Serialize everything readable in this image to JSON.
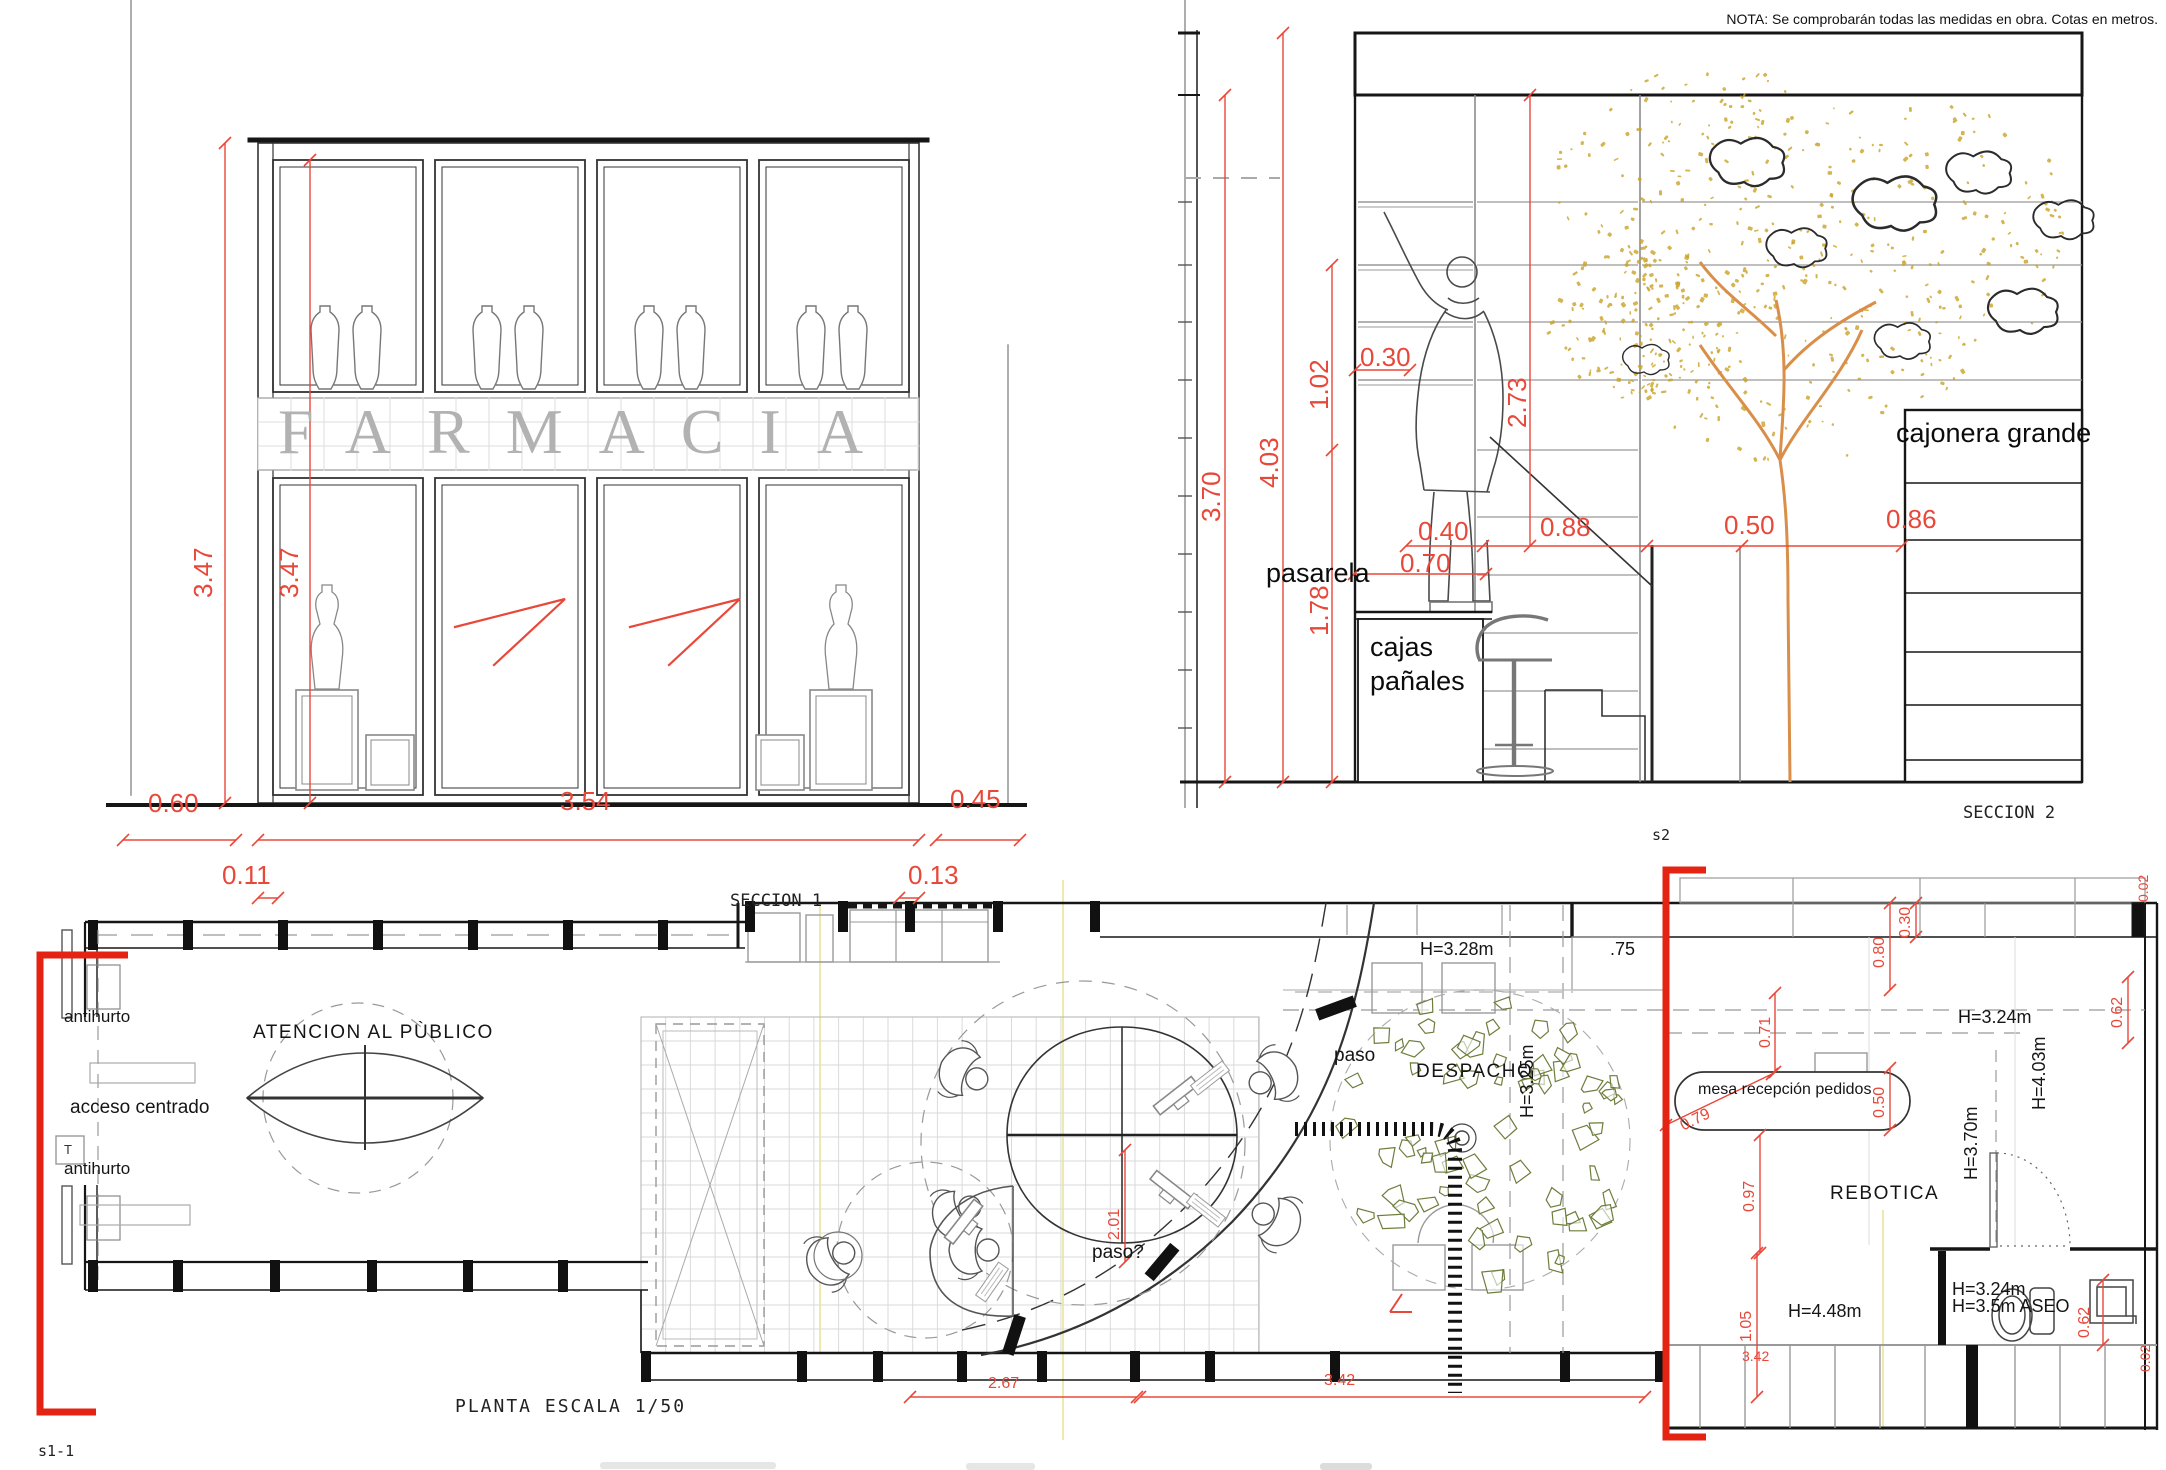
{
  "note": "NOTA: Se comprobarán todas las medidas en obra. Cotas en metros.",
  "section1": {
    "title": "SECCION 1",
    "sign": "FARMACIA",
    "dims": {
      "h_total": "3.47",
      "h_inner": "3.47",
      "w_left": "0.60",
      "w_main": "3.54",
      "w_right": "0.45",
      "o_left": "0.11",
      "o_right": "0.13"
    }
  },
  "section2": {
    "title": "SECCION 2",
    "marker": "s2",
    "labels": {
      "pasarela": "pasarela",
      "cajas_line1": "cajas",
      "cajas_line2": "pañales",
      "cajonera": "cajonera grande"
    },
    "dims": {
      "d370": "3.70",
      "d403": "4.03",
      "d102": "1.02",
      "d030": "0.30",
      "d273": "2.73",
      "d178": "1.78",
      "d040": "0.40",
      "d070": "0.70",
      "d088": "0.88",
      "d050": "0.50",
      "d086": "0.86"
    }
  },
  "plan": {
    "title": "PLANTA ESCALA 1/50",
    "marker_s1": "s1-1",
    "labels": {
      "antihurto_top": "antihurto",
      "antihurto_bottom": "antihurto",
      "t_box": "T",
      "acceso": "acceso centrado",
      "atencion": "ATENCION AL PÙBLICO",
      "paso": "paso",
      "paso_q": "paso?",
      "despacho": "DESPACHO",
      "h328": "H=3.28m",
      "p75": ".75",
      "h325": "H=3.25m",
      "mesa": "mesa recepción pedidos",
      "rebotica": "REBOTICA",
      "h324": "H=3.24m",
      "h403": "H=4.03m",
      "h370": "H=3.70m",
      "h324b": "H=3.24m",
      "h35aseo": "H=3.5m ASEO",
      "h448": "H=4.48m"
    },
    "dims": {
      "d030": "0.30",
      "d080": "0.80",
      "d071": "0.71",
      "d062": "0.62",
      "d050": "0.50",
      "d079": "0.79",
      "d097": "0.97",
      "d105": "1.05",
      "d062b": "0.62",
      "d201": "2.01",
      "d267": "2.67",
      "d342": "3.42",
      "d342b": "3.42",
      "d002a": "0.02",
      "d002b": "0.02"
    }
  },
  "colors": {
    "dim_red": "#e8483a",
    "marker_red": "#e42313",
    "line_black": "#1c1c1c",
    "line_grey": "#8a8a8a",
    "foliage_gold": "#c9a227",
    "trunk_orange": "#d98f4a",
    "leaf_green": "#6e7d3c",
    "sign_grey": "#b2b2b2"
  }
}
